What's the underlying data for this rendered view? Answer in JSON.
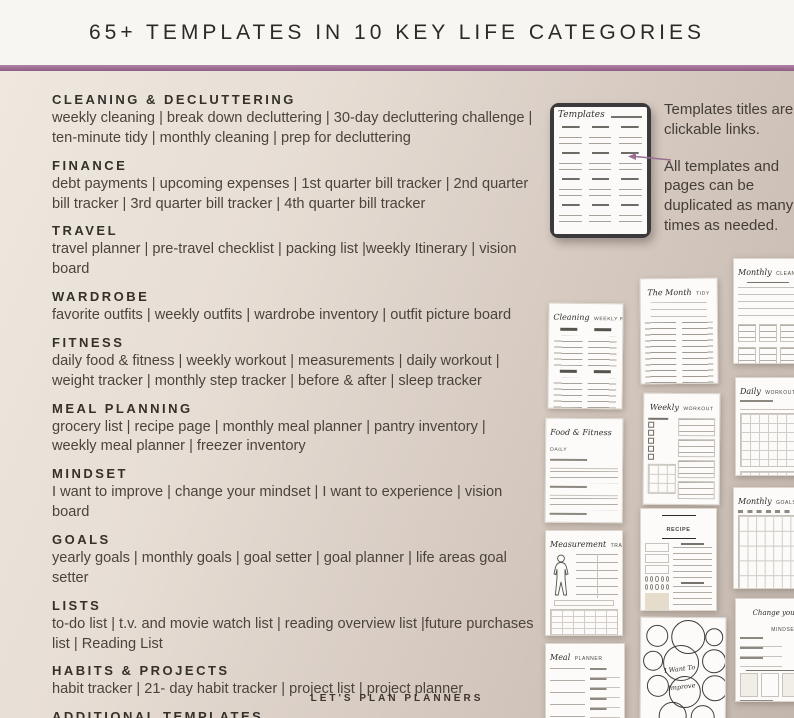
{
  "header": {
    "title": "65+ TEMPLATES IN 10 KEY LIFE CATEGORIES"
  },
  "categories": [
    {
      "name": "CLEANING & DECLUTTERING",
      "items": "weekly cleaning | break down decluttering | 30-day decluttering challenge | ten-minute tidy | monthly cleaning | prep for decluttering"
    },
    {
      "name": "FINANCE",
      "items": "debt payments | upcoming expenses | 1st quarter bill tracker | 2nd quarter bill tracker | 3rd quarter bill tracker | 4th quarter bill tracker"
    },
    {
      "name": "TRAVEL",
      "items": "travel planner | pre-travel checklist | packing list |weekly Itinerary | vision board"
    },
    {
      "name": "WARDROBE",
      "items": "favorite outfits | weekly outfits | wardrobe inventory | outfit picture board"
    },
    {
      "name": "FITNESS",
      "items": "daily food & fitness | weekly workout | measurements | daily workout | weight tracker | monthly step tracker | before & after | sleep tracker"
    },
    {
      "name": "MEAL PLANNING",
      "items": "grocery list | recipe page | monthly meal planner | pantry inventory | weekly meal planner | freezer inventory"
    },
    {
      "name": "MINDSET",
      "items": "I want to improve | change your mindset | I want to experience | vision board"
    },
    {
      "name": "GOALS",
      "items": "yearly goals | monthly goals | goal setter | goal planner | life areas goal setter"
    },
    {
      "name": "LISTS",
      "items": "to-do list | t.v. and movie watch list | reading overview list |future purchases list | Reading List"
    },
    {
      "name": "HABITS & PROJECTS",
      "items": "habit tracker | 21- day habit tracker | project list | project planner"
    },
    {
      "name": "ADDITIONAL TEMPLATES",
      "items": "password tracker | birthday tracker | sticker pages | 9 - note papers"
    }
  ],
  "tablet": {
    "screen_title": "Templates"
  },
  "notes": {
    "clickable": "Templates titles are clickable links.",
    "duplicate": "All templates and pages can be duplicated as many times as needed."
  },
  "thumbnails": [
    {
      "script": "Cleaning",
      "caps": "WEEKLY ROUTINE"
    },
    {
      "script": "The Month",
      "caps": "TIDY"
    },
    {
      "script": "Monthly",
      "caps": "CLEANING"
    },
    {
      "script": "Food & Fitness",
      "caps": "DAILY"
    },
    {
      "script": "Weekly",
      "caps": "WORKOUT"
    },
    {
      "script": "Daily",
      "caps": "WORKOUT"
    },
    {
      "script": "Measurement",
      "caps": "TRACKER"
    },
    {
      "caps": "RECIPE"
    },
    {
      "script": "Monthly",
      "caps": "GOALS"
    },
    {
      "script": "Meal",
      "caps": "PLANNER"
    },
    {
      "script_line1": "I Want To",
      "script_line2": "Improve"
    },
    {
      "script": "Change your",
      "caps": "MINDSET"
    }
  ],
  "footer": {
    "brand": "LET'S PLAN PLANNERS"
  },
  "colors": {
    "divider": "#96648c",
    "arrow": "#9b6e93"
  }
}
